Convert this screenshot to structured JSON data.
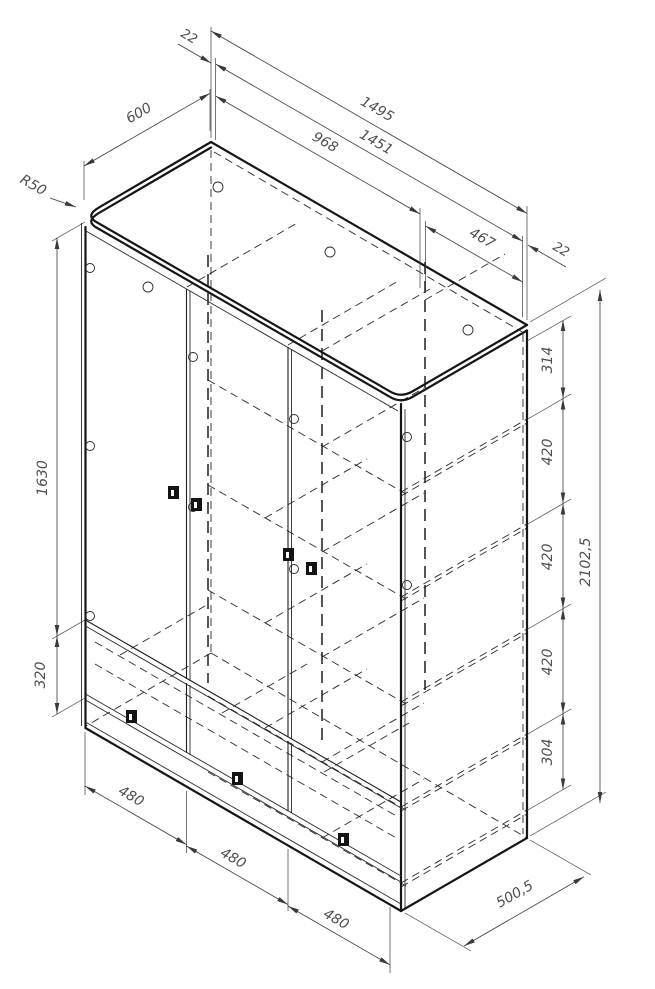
{
  "drawing_colors": {
    "ink": "#161616",
    "dimension_line": "#3a3a3a",
    "label": "#4f4f4f",
    "background": "#ffffff"
  },
  "dims": {
    "corner_radius": "R50",
    "top": {
      "thickness_left": "22",
      "overall_width": "1495",
      "interior_width": "1451",
      "partition_position": "968",
      "right_section_width": "467",
      "thickness_right": "22",
      "depth": "600"
    },
    "left": {
      "door_height": "1630",
      "drawer_section_height": "320"
    },
    "right": {
      "spacings": [
        "314",
        "420",
        "420",
        "420",
        "304"
      ],
      "overall_height": "2102,5"
    },
    "bottom": {
      "door_widths": [
        "480",
        "480",
        "480"
      ],
      "depth": "500,5"
    }
  }
}
